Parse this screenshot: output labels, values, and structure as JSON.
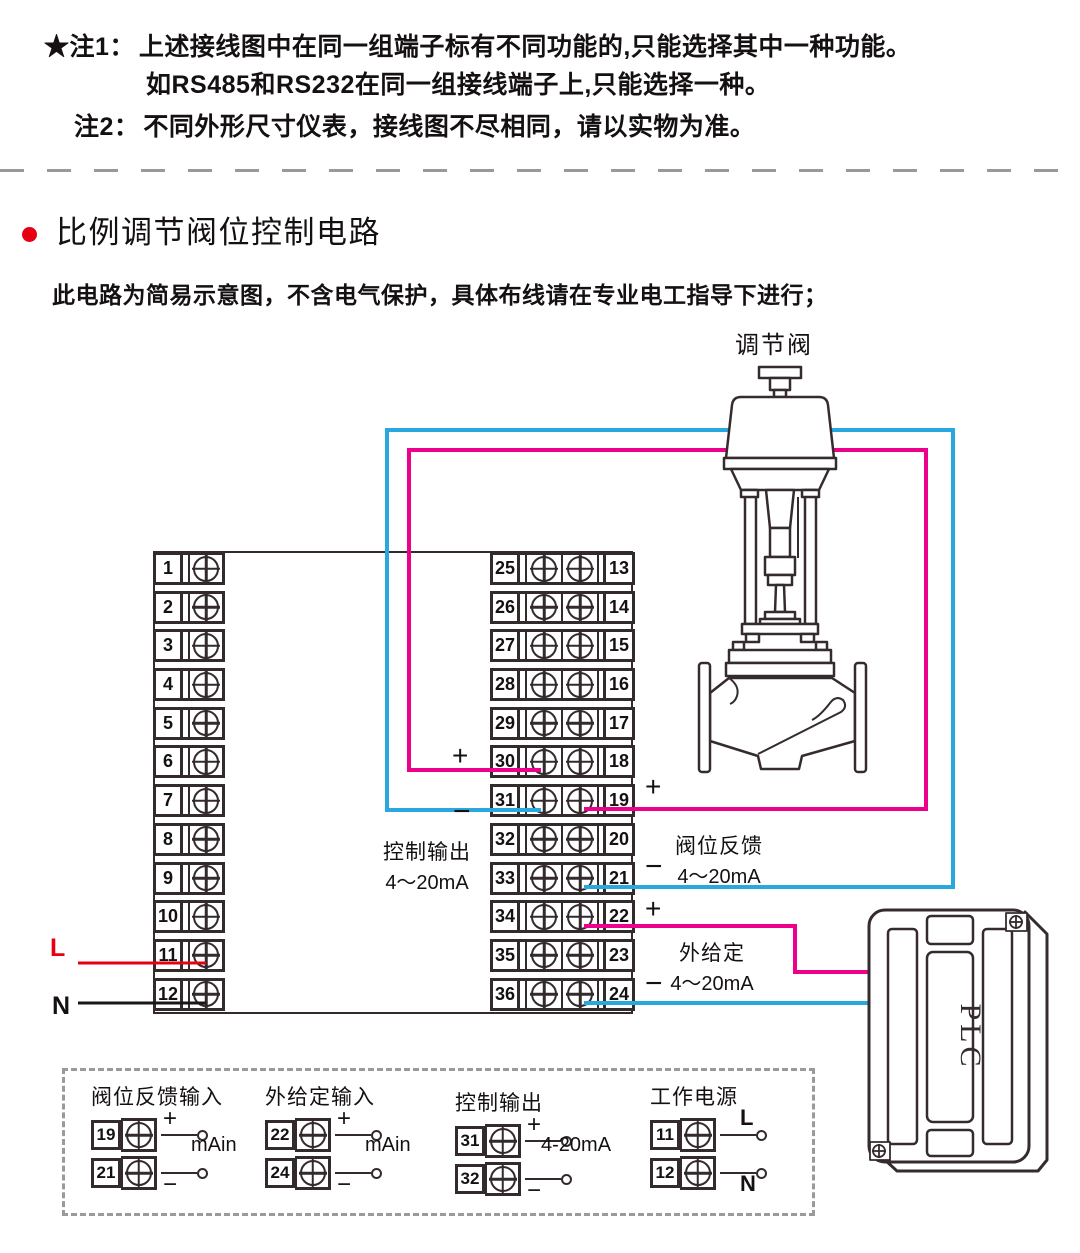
{
  "notes": {
    "note1_label": "★注1：",
    "note1_line1": "上述接线图中在同一组端子标有不同功能的,只能选择其中一种功能。",
    "note1_line2": "如RS485和RS232在同一组接线端子上,只能选择一种。",
    "note2_label": "注2：",
    "note2_text": "不同外形尺寸仪表，接线图不尽相同，请以实物为准。"
  },
  "section": {
    "title": "比例调节阀位控制电路",
    "subtitle": "此电路为简易示意图，不含电气保护，具体布线请在专业电工指导下进行；"
  },
  "diagram": {
    "valve_label": "调节阀",
    "plc_label": "PLC",
    "left_terminals": [
      "1",
      "2",
      "3",
      "4",
      "5",
      "6",
      "7",
      "8",
      "9",
      "10",
      "11",
      "12"
    ],
    "middle_terminals_left": [
      "25",
      "26",
      "27",
      "28",
      "29",
      "30",
      "31",
      "32",
      "33",
      "34",
      "35",
      "36"
    ],
    "middle_terminals_right": [
      "13",
      "14",
      "15",
      "16",
      "17",
      "18",
      "19",
      "20",
      "21",
      "22",
      "23",
      "24"
    ],
    "labels": {
      "control_output": "控制输出",
      "control_output_range": "4～20mA",
      "valve_feedback": "阀位反馈",
      "valve_feedback_range": "4～20mA",
      "external_setpoint": "外给定",
      "external_setpoint_range": "4～20mA",
      "line_l": "L",
      "line_n": "N",
      "plus": "+",
      "minus": "−"
    },
    "colors": {
      "pink": "#ec008c",
      "blue": "#29a8e0",
      "red": "#e60012",
      "black": "#1a1617",
      "line": "#352b2d"
    }
  },
  "legend": {
    "groups": [
      {
        "title": "阀位反馈输入",
        "range": "mAin",
        "rows": [
          {
            "num": "19",
            "sign": "+"
          },
          {
            "num": "21",
            "sign": "−"
          }
        ]
      },
      {
        "title": "外给定输入",
        "range": "mAin",
        "rows": [
          {
            "num": "22",
            "sign": "+"
          },
          {
            "num": "24",
            "sign": "−"
          }
        ]
      },
      {
        "title": "控制输出",
        "range": "4-20mA",
        "rows": [
          {
            "num": "31",
            "sign": "+"
          },
          {
            "num": "32",
            "sign": "−"
          }
        ]
      },
      {
        "title": "工作电源",
        "range": "",
        "rows": [
          {
            "num": "11",
            "sign": "L"
          },
          {
            "num": "12",
            "sign": "N"
          }
        ]
      }
    ]
  }
}
